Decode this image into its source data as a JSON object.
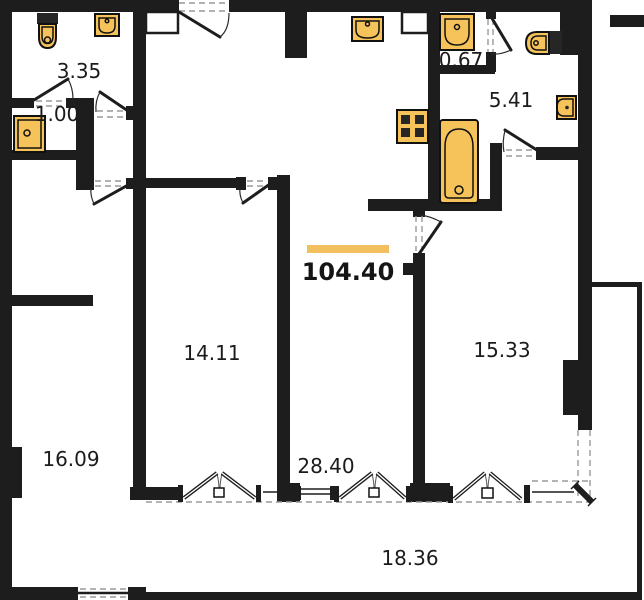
{
  "floorplan": {
    "total_area": {
      "value": "104.40"
    },
    "rooms": [
      {
        "id": "bathroom-top-left",
        "area": "3.35"
      },
      {
        "id": "shower-room",
        "area": "1.00"
      },
      {
        "id": "wc-small",
        "area": "0.67"
      },
      {
        "id": "bathroom-right",
        "area": "5.41"
      },
      {
        "id": "bedroom-center",
        "area": "14.11"
      },
      {
        "id": "bedroom-right",
        "area": "15.33"
      },
      {
        "id": "bedroom-left",
        "area": "16.09"
      },
      {
        "id": "living-kitchen",
        "area": "28.40"
      },
      {
        "id": "balcony",
        "area": "18.36"
      }
    ],
    "fixtures": [
      "toilet",
      "sink",
      "shower-tray",
      "kitchen-sink",
      "stove",
      "washbasin",
      "toilet",
      "water-heater",
      "bathtub"
    ],
    "colors": {
      "wall": "#1d1d1d",
      "fixture_fill": "#F6C35B",
      "accent_bar": "#F2BF5E",
      "background": "#ffffff"
    }
  }
}
